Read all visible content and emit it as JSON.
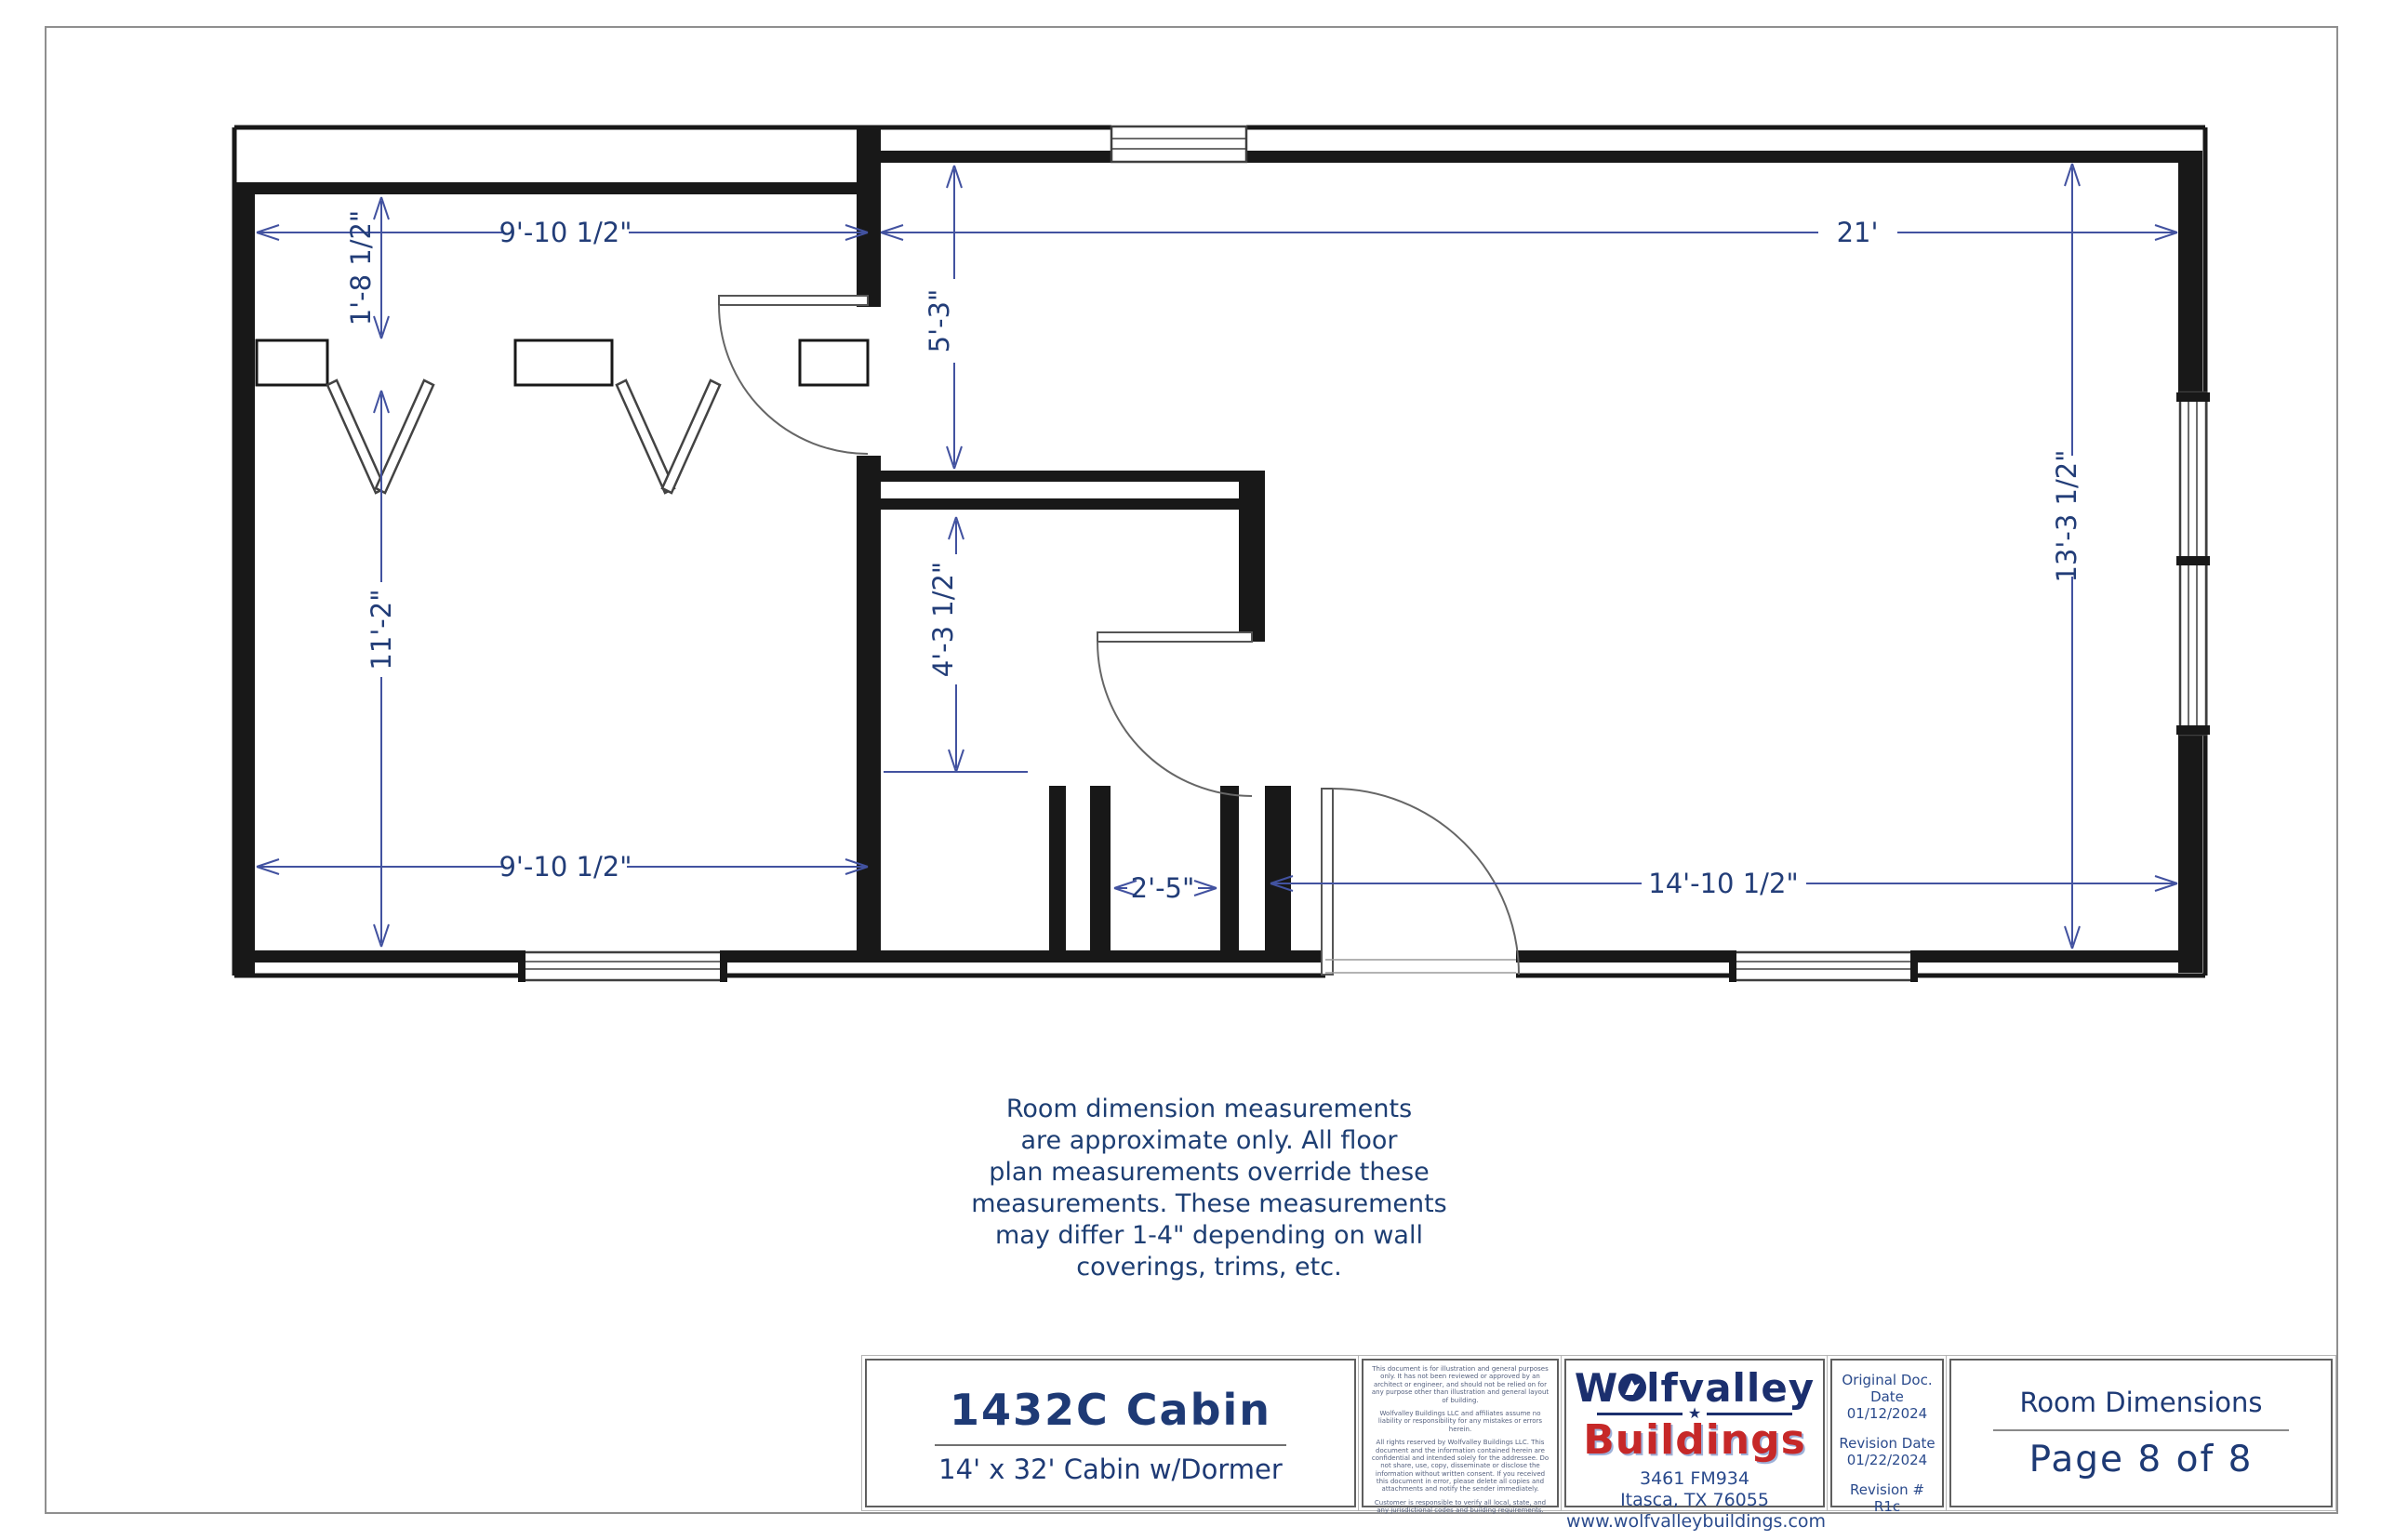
{
  "plan": {
    "dims": {
      "closet_depth": "1'-8 1/2\"",
      "left_width_top": "9'-10 1/2\"",
      "great_width": "21'",
      "north_to_bath": "5'-3\"",
      "bath_depth": "4'-3 1/2\"",
      "left_height": "11'-2\"",
      "left_width_bottom": "9'-10 1/2\"",
      "alcove_width": "2'-5\"",
      "great_width_bottom": "14'-10 1/2\"",
      "great_height": "13'-3 1/2\""
    },
    "colors": {
      "wall": "#181818",
      "dim_line": "#4252a0",
      "dim_text": "#223d78"
    }
  },
  "note": {
    "lines": [
      "Room dimension measurements",
      "are approximate only. All floor",
      "plan measurements override these",
      "measurements. These measurements",
      "may differ 1-4\" depending on wall",
      "coverings, trims, etc."
    ]
  },
  "title_block": {
    "model": "1432C Cabin",
    "subtitle": "14' x 32' Cabin w/Dormer",
    "disclaimer_paragraphs": [
      "This document is for illustration and general purposes only. It has not been reviewed or approved by an architect or engineer, and should not be relied on for any purpose other than illustration and general layout of building.",
      "Wolfvalley Buildings LLC and affiliates assume no liability or responsibility for any mistakes or errors herein.",
      "All rights reserved by Wolfvalley Buildings LLC. This document and the information contained herein are confidential and intended solely for the addressee. Do not share, use, copy, disseminate or disclose the information without written consent. If you received this document in error, please delete all copies and attachments and notify the sender immediately.",
      "Customer is responsible to verify all local, state, and any jurisdictional codes and building requirements."
    ],
    "logo": {
      "line1_pre": "W",
      "line1_post": "lfvalley",
      "line2": "Buildings",
      "address1": "3461 FM934",
      "address2": "Itasca, TX 76055",
      "website": "www.wolfvalleybuildings.com",
      "navy": "#1b2f6e",
      "red": "#c62828"
    },
    "doc_dates": {
      "original_label": "Original Doc. Date",
      "original_value": "01/12/2024",
      "revision_label": "Revision Date",
      "revision_value": "01/22/2024",
      "revnum_label": "Revision #",
      "revnum_value": "R1c"
    },
    "sheet": {
      "title": "Room Dimensions",
      "page": "Page 8 of 8"
    }
  }
}
